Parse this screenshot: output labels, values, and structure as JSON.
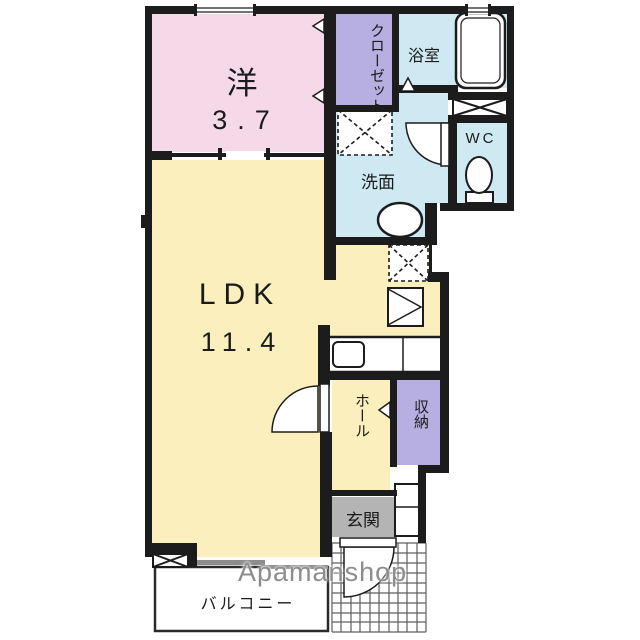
{
  "rooms": {
    "western": {
      "label": "洋",
      "size": "3.7"
    },
    "ldk": {
      "label": "LDK",
      "size": "11.4"
    },
    "closet": {
      "label": "クローゼット"
    },
    "bath": {
      "label": "浴室"
    },
    "wc": {
      "label": "WC"
    },
    "washroom": {
      "label": "洗面"
    },
    "hall": {
      "label": "ホール"
    },
    "storage": {
      "label": "収納"
    },
    "entrance": {
      "label": "玄関"
    },
    "balcony": {
      "label": "バルコニー"
    }
  },
  "watermark": "Apamanshop",
  "colors": {
    "western_room": "#f6d9e8",
    "ldk": "#faefbd",
    "closet": "#b7aee2",
    "storage": "#b7aee2",
    "wet_area": "#cfe9f3",
    "entrance_floor": "#b4b4b4",
    "wall": "#1c1c1c"
  }
}
